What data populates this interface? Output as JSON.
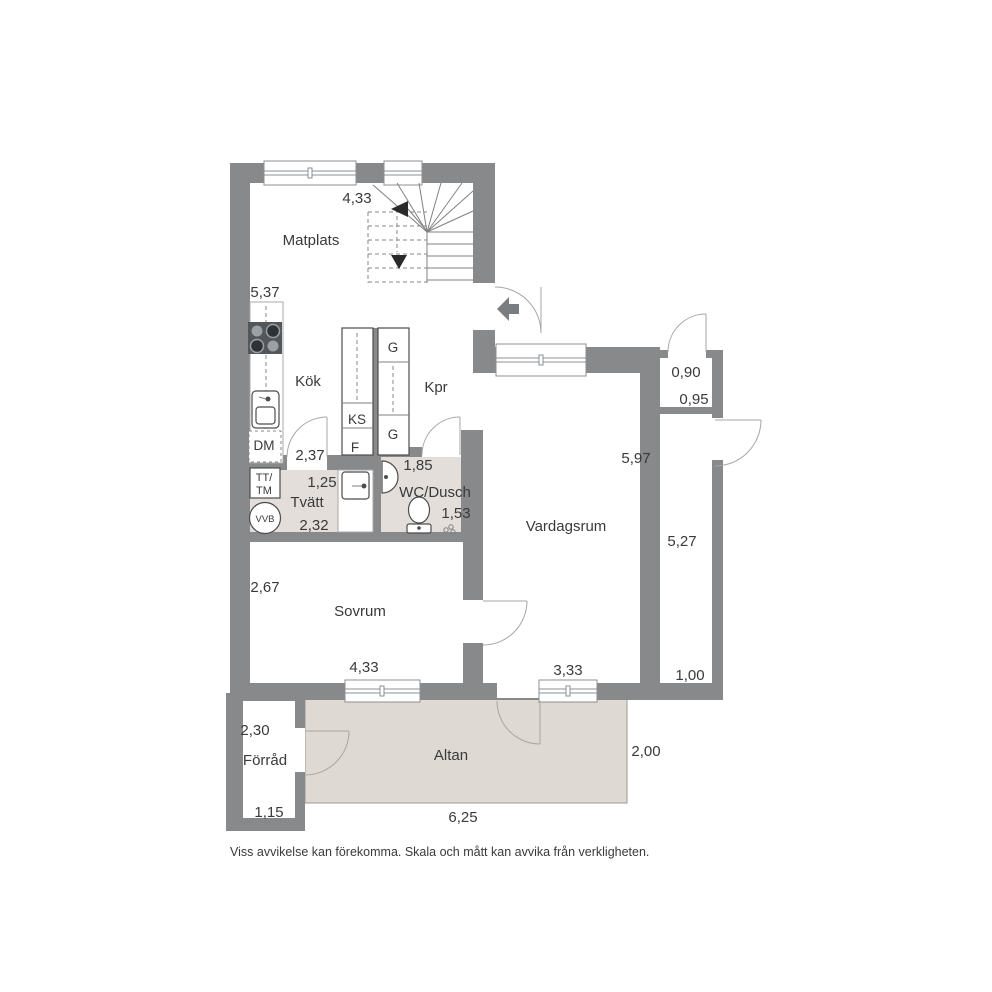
{
  "colors": {
    "wall": "#87898b",
    "wet_floor": "#e3ded9",
    "terrace_floor": "#dfd9d3",
    "arrow": "#7b7e81",
    "text": "#3a3a3a"
  },
  "rooms": {
    "matplats": "Matplats",
    "kok": "Kök",
    "kpr": "Kpr",
    "tvatt": "Tvätt",
    "wc_dusch": "WC/Dusch",
    "vardagsrum": "Vardagsrum",
    "sovrum": "Sovrum",
    "forrad": "Förråd",
    "altan": "Altan"
  },
  "fixtures": {
    "ks": "KS",
    "f": "F",
    "g_upper": "G",
    "g_lower": "G",
    "dm": "DM",
    "tt": "TT/",
    "tm": "TM",
    "vvb": "VVB"
  },
  "dimensions": {
    "matplats_width": "4,33",
    "kitchen_wall": "5,37",
    "kok_door": "2,37",
    "tvatt_width": "1,25",
    "tvatt_depth": "2,32",
    "wc_width": "1,85",
    "wc_depth": "1,53",
    "vardagsrum_height": "5,97",
    "alcove_width": "0,90",
    "alcove_depth": "0,95",
    "passage_length": "5,27",
    "passage_width": "1,00",
    "sovrum_depth": "2,67",
    "sovrum_width": "4,33",
    "vardagsrum_window": "3,33",
    "altan_depth": "2,00",
    "forrad_depth": "2,30",
    "forrad_width": "1,15",
    "altan_width": "6,25"
  },
  "disclaimer": "Viss avvikelse kan förekomma. Skala och mått kan avvika från verkligheten."
}
